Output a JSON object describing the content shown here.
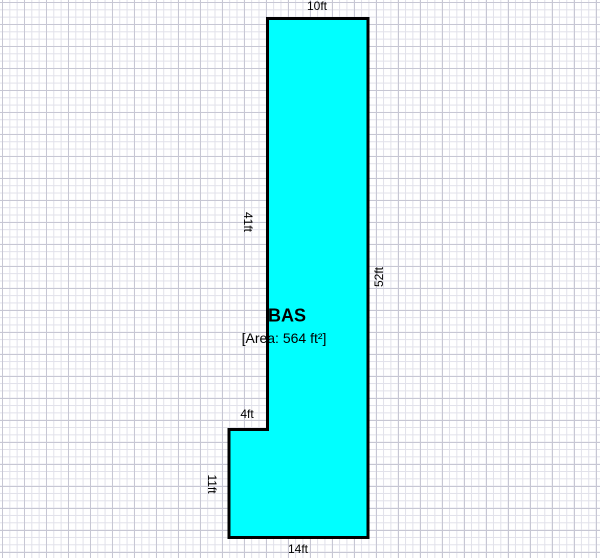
{
  "sketch": {
    "room_label": "BAS",
    "area_label": "[Area: 564 ft²]",
    "area_value": 564,
    "fill_color": "#00ffff",
    "outline_color": "#000000",
    "polygon_points": "267.5,18.5 368,18.5 368,537.5 229,537.5 229,429.5 267.5,429.5",
    "dimensions": {
      "top": "10ft",
      "left_upper": "41ft",
      "right": "52ft",
      "notch": "4ft",
      "left_lower": "11ft",
      "bottom": "14ft"
    }
  }
}
